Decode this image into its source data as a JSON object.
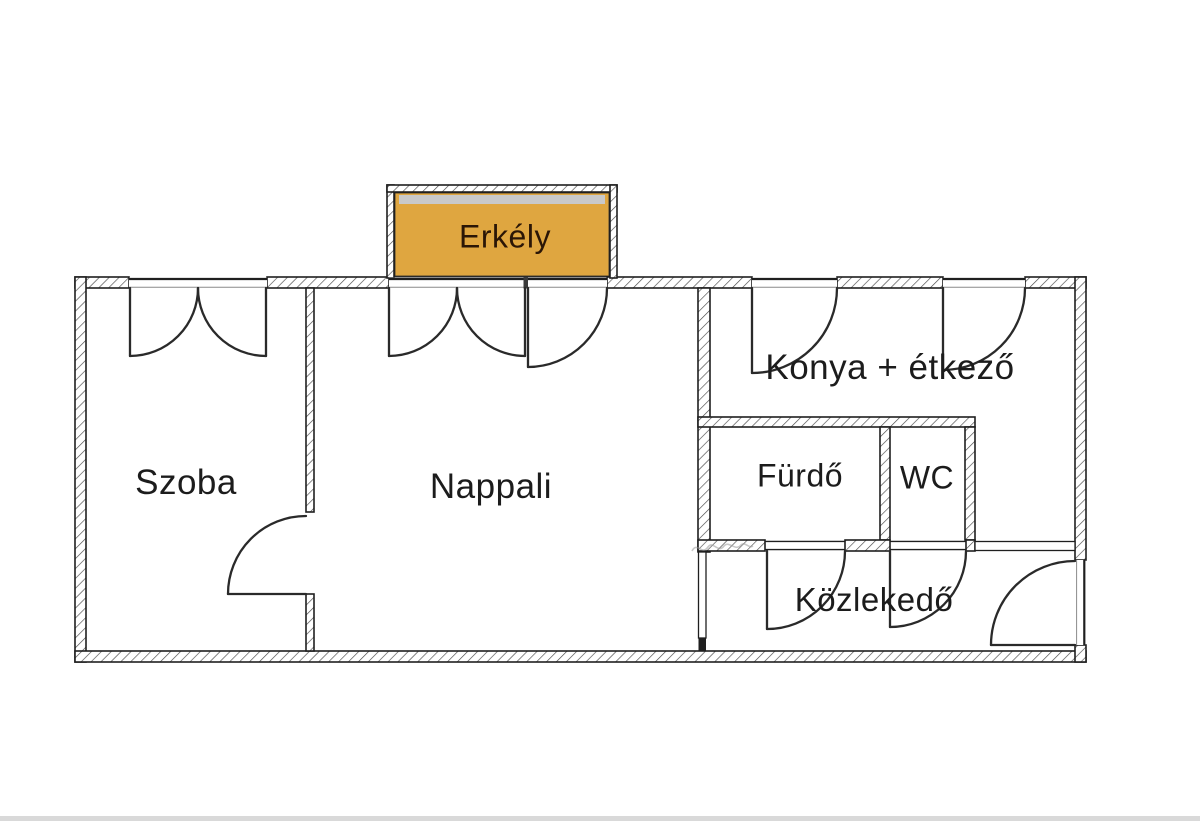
{
  "colors": {
    "background": "#ffffff",
    "wall_outline": "#1f1f1f",
    "hatch_line": "#4a4a4a",
    "door_stroke": "#2a2a2a",
    "label_text": "#1c1c1c",
    "balcony_fill": "#dfa640",
    "balcony_strip": "#c9c9c9",
    "balcony_text": "#2b1606",
    "bottom_bar": "#d9d9d9",
    "watermark": "#9a9a9a"
  },
  "floorplan": {
    "rooms": {
      "balcony": {
        "label": "Erkély"
      },
      "bedroom": {
        "label": "Szoba"
      },
      "living_room": {
        "label": "Nappali"
      },
      "kitchen_dining": {
        "label": "Konya + étkező"
      },
      "bathroom": {
        "label": "Fürdő"
      },
      "toilet": {
        "label": "WC"
      },
      "hallway": {
        "label": "Közlekedő"
      }
    }
  }
}
